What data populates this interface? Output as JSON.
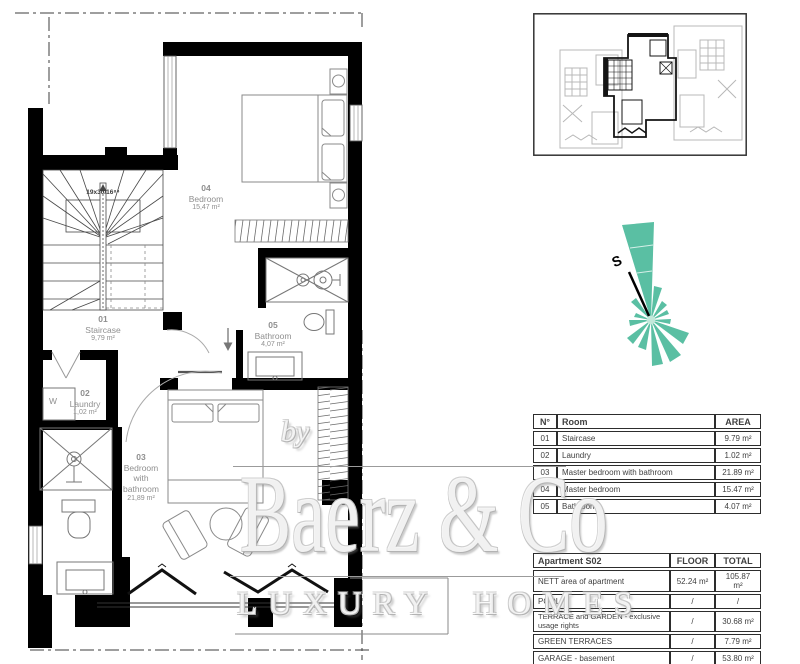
{
  "plan": {
    "stair_note": "19x30/16⁸⁴",
    "washer_label": "W",
    "compass_label": "S",
    "rooms": [
      {
        "num": "01",
        "name": "Staircase",
        "area": "9,79 m²"
      },
      {
        "num": "02",
        "name": "Laundry",
        "area": "1,02 m²"
      },
      {
        "num": "03",
        "name": "Bedroom\nwith\nbathroom",
        "area": "21,89 m²"
      },
      {
        "num": "04",
        "name": "Bedroom",
        "area": "15,47 m²"
      },
      {
        "num": "05",
        "name": "Bathroom",
        "area": "4,07 m²"
      }
    ]
  },
  "room_table": {
    "headers": {
      "num": "N°",
      "room": "Room",
      "area": "AREA"
    },
    "rows": [
      {
        "num": "01",
        "room": "Staircase",
        "area": "9.79 m²"
      },
      {
        "num": "02",
        "room": "Laundry",
        "area": "1.02 m²"
      },
      {
        "num": "03",
        "room": "Master bedroom with bathroom",
        "area": "21.89 m²"
      },
      {
        "num": "04",
        "room": "Master bedroom",
        "area": "15.47 m²"
      },
      {
        "num": "05",
        "room": "Bathroom",
        "area": "4.07 m²"
      }
    ]
  },
  "apartment_table": {
    "title": "Apartment S02",
    "col_floor": "FLOOR",
    "col_total": "TOTAL",
    "rows": [
      {
        "label": "NETT area of apartment",
        "floor": "52.24 m²",
        "total": "105.87 m²"
      },
      {
        "label": "POOL",
        "floor": "/",
        "total": "/"
      },
      {
        "label": "TERRACE and GARDEN - exclusive usage rights",
        "floor": "/",
        "total": "30.68 m²"
      },
      {
        "label": "GREEN TERRACES",
        "floor": "/",
        "total": "7.79 m²"
      },
      {
        "label": "GARAGE - basement",
        "floor": "/",
        "total": "53.80 m²"
      }
    ]
  },
  "watermark": {
    "by": "by",
    "brand": "Baerz & Co",
    "tagline": "LUXURY HOMES"
  },
  "colors": {
    "compass_fill": "#5ABFA3",
    "wall": "#000000",
    "label_gray": "#8f8f8f"
  }
}
